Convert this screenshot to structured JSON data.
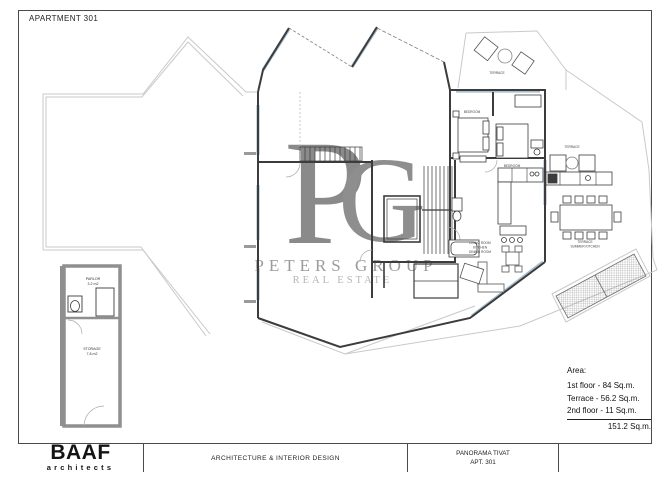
{
  "header": {
    "title": "APARTMENT 301"
  },
  "watermark": {
    "letter_p": "P",
    "letter_g": "G",
    "line1": "PETERS GROUP",
    "line2": "REAL ESTATE",
    "color": "#8a8a8a"
  },
  "area_summary": {
    "heading": "Area:",
    "lines": [
      "1st floor - 84 Sq.m.",
      "Terrace - 56.2 Sq.m.",
      "2nd floor - 11 Sq.m."
    ],
    "total": "151.2 Sq.m."
  },
  "title_block": {
    "logo_main": "BAAF",
    "logo_sub": "architects",
    "studio": "ARCHITECTURE & INTERIOR DESIGN",
    "project": "PANORAMA TIVAT",
    "sheet": "APT. 301"
  },
  "plan": {
    "labels": {
      "terrace_top": "TERRACE",
      "bedroom1": "BEDROOM",
      "bedroom2": "BEDROOM",
      "terrace_right": "TERRACE",
      "summer_kitchen_1": "TERRACE",
      "summer_kitchen_2": "SUMMER KITCHEN",
      "living_1": "LIVING ROOM",
      "living_2": "KITCHEN",
      "living_3": "DINING ROOM",
      "parlor_name": "PARLOR",
      "parlor_area": "3.2 m2",
      "storage_name": "STORAGE",
      "storage_area": "7.8 m2"
    },
    "colors": {
      "walls": "#3c3c3c",
      "glazing": "#a9bfce",
      "terrace_outline": "#c9c9c9",
      "annex_wall": "#8f8f8f"
    }
  }
}
